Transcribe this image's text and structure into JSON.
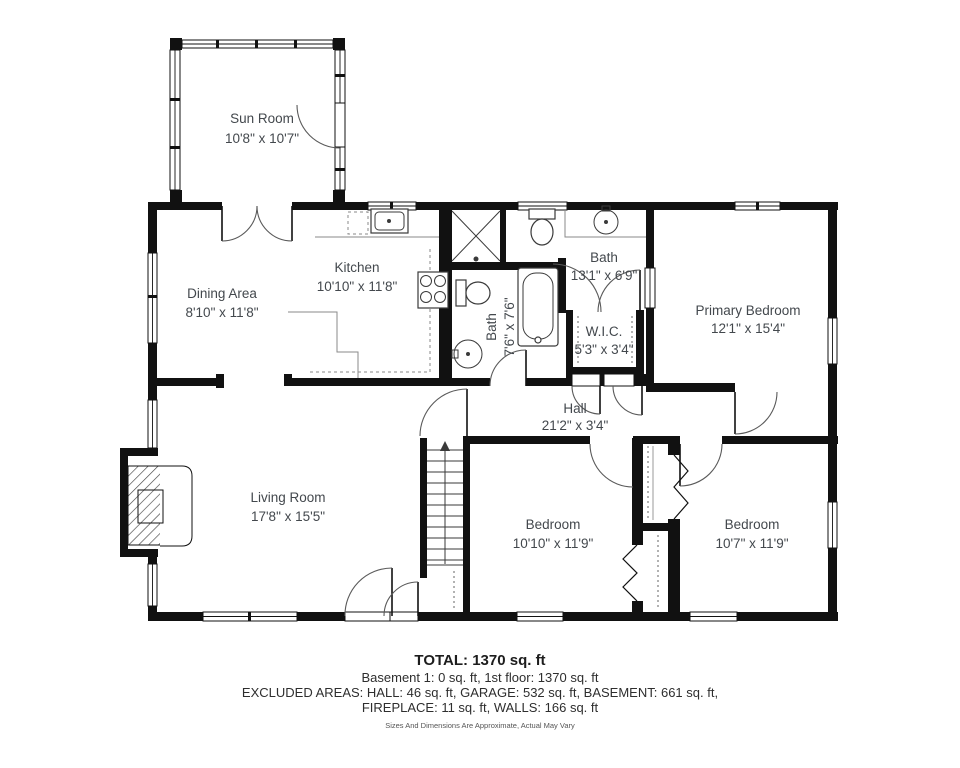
{
  "rooms": {
    "sun_room": {
      "name": "Sun Room",
      "dims": "10'8\" x 10'7\""
    },
    "dining": {
      "name": "Dining Area",
      "dims": "8'10\" x 11'8\""
    },
    "kitchen": {
      "name": "Kitchen",
      "dims": "10'10\" x 11'8\""
    },
    "bath_main": {
      "name": "Bath",
      "dims": "13'1\" x 6'9\""
    },
    "bath_small": {
      "name": "Bath",
      "dims": "7'6\" x 7'6\""
    },
    "wic": {
      "name": "W.I.C.",
      "dims": "5'3\" x 3'4\""
    },
    "primary_bedroom": {
      "name": "Primary Bedroom",
      "dims": "12'1\" x 15'4\""
    },
    "hall": {
      "name": "Hall",
      "dims": "21'2\" x 3'4\""
    },
    "living_room": {
      "name": "Living Room",
      "dims": "17'8\" x 15'5\""
    },
    "bedroom_left": {
      "name": "Bedroom",
      "dims": "10'10\" x 11'9\""
    },
    "bedroom_right": {
      "name": "Bedroom",
      "dims": "10'7\" x 11'9\""
    }
  },
  "footer": {
    "total": "TOTAL: 1370 sq. ft",
    "line1": "Basement 1: 0 sq. ft, 1st floor: 1370 sq. ft",
    "line2": "EXCLUDED AREAS: HALL: 46 sq. ft, GARAGE: 532 sq. ft, BASEMENT: 661 sq. ft,",
    "line3": "FIREPLACE: 11 sq. ft, WALLS: 166 sq. ft",
    "disclaimer": "Sizes And Dimensions Are Approximate, Actual May Vary"
  },
  "colors": {
    "wall": "#111111",
    "label_text": "#43484d",
    "footer_text": "#2e2e2e",
    "background": "#ffffff"
  }
}
